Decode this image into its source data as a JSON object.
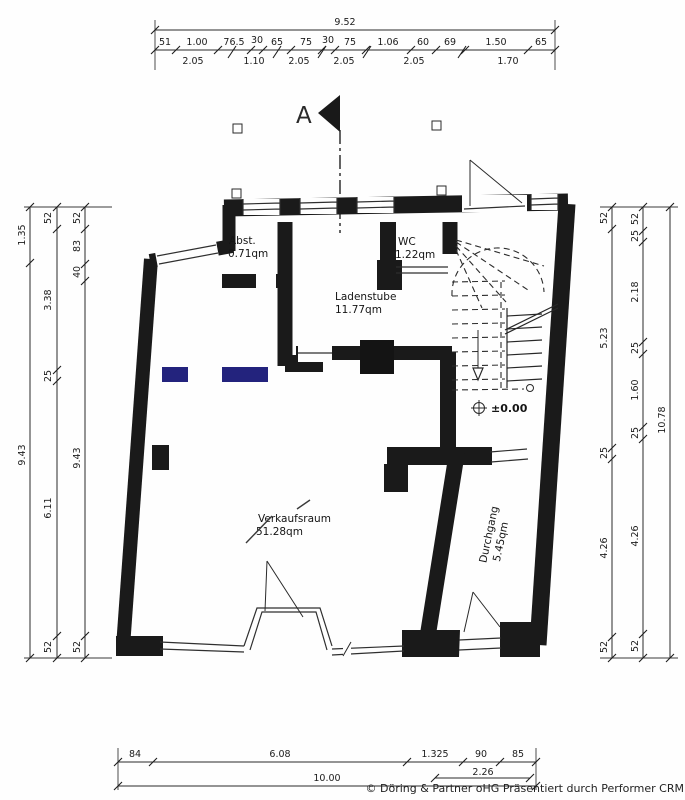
{
  "meta": {
    "copyright": "© Döring & Partner oHG Präsentiert durch Performer CRM"
  },
  "colors": {
    "ink": "#1a1a1a",
    "highlight_blue": "#23237d",
    "paper": "#fefefe"
  },
  "section_marker": {
    "letter": "A"
  },
  "level_marker": {
    "label": "±0.00"
  },
  "rooms": {
    "abst": {
      "name": "Abst.",
      "area": "0.71qm"
    },
    "wc": {
      "name": "WC",
      "area": "1.22qm"
    },
    "ladenstube": {
      "name": "Ladenstube",
      "area": "11.77qm"
    },
    "verkaufsraum": {
      "name": "Verkaufsraum",
      "area": "51.28qm"
    },
    "durchgang": {
      "name": "Durchgang",
      "area": "5.45qm"
    }
  },
  "dimensions": {
    "top": {
      "overall": "9.52",
      "row1": [
        "51",
        "1.00",
        "76.5",
        "30",
        "65",
        "75",
        "30",
        "75",
        "1.06",
        "60",
        "69",
        "1.50",
        "65"
      ],
      "row2": [
        "2.05",
        "1.10",
        "2.05",
        "2.05",
        "2.05",
        "1.70"
      ]
    },
    "left": {
      "outer": [
        "1.35",
        "9.43"
      ],
      "middle": [
        "52",
        "3.38",
        "25",
        "6.11",
        "52"
      ],
      "inner": [
        "52",
        "83",
        "40",
        "9.43",
        "52"
      ]
    },
    "right": {
      "inner": [
        "52",
        "5.23",
        "25",
        "4.26",
        "52"
      ],
      "middle": [
        "52",
        "25",
        "2.18",
        "25",
        "1.60",
        "25",
        "4.26",
        "52"
      ],
      "outer": [
        "10.78"
      ]
    },
    "bottom": {
      "row1": [
        "84",
        "6.08",
        "1.325",
        "90",
        "85"
      ],
      "sub": "2.26",
      "overall": "10.00"
    }
  }
}
